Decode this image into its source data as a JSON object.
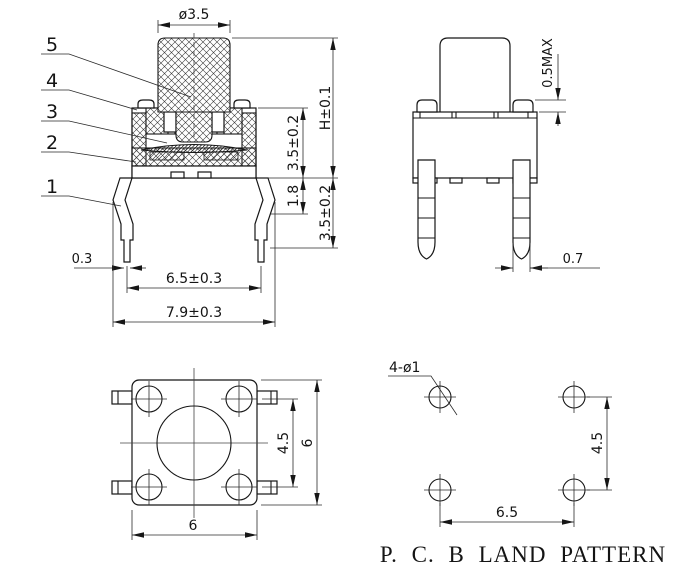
{
  "front": {
    "labels": [
      "5",
      "4",
      "3",
      "2",
      "1"
    ],
    "stem_dia": "ø3.5",
    "total_height": "H±0.1",
    "body_height": "3.5±0.2",
    "bend_height": "1.8",
    "pin_length": "3.5±0.2",
    "tip_width": "0.3",
    "pin_span": "6.5±0.3",
    "overall_width": "7.9±0.3"
  },
  "side": {
    "boss_height": "0.5MAX",
    "pin_thickness": "0.7"
  },
  "top": {
    "pin_row_pitch": "4.5",
    "body_width": "6",
    "body_depth": "6"
  },
  "pcb": {
    "hole_callout": "4-ø1",
    "hole_pitch_v": "4.5",
    "hole_pitch_h": "6.5",
    "title": "P. C. B LAND PATTERN"
  }
}
